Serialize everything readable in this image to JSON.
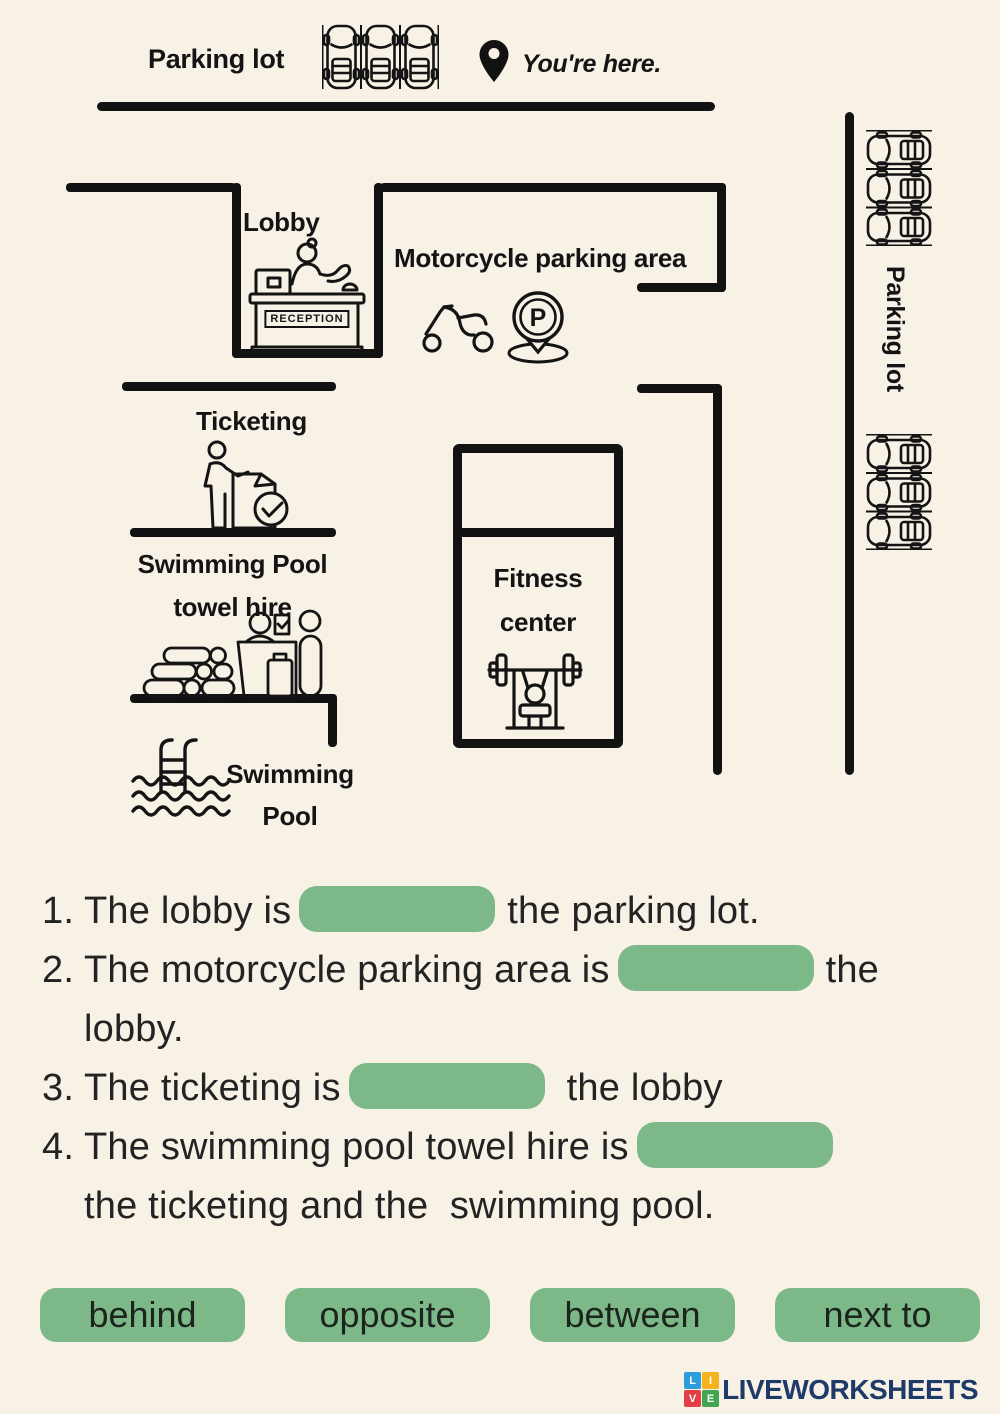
{
  "map": {
    "parking_top_label": "Parking lot",
    "youre_here": "You're here.",
    "lobby": "Lobby",
    "reception": "RECEPTION",
    "motorcycle": "Motorcycle parking area",
    "p_letter": "P",
    "ticketing": "Ticketing",
    "towel_hire": {
      "line1": "Swimming Pool",
      "line2": "towel hire"
    },
    "fitness": {
      "line1": "Fitness",
      "line2": "center"
    },
    "pool": {
      "line1": "Swimming",
      "line2": "Pool"
    },
    "parking_right_label": "Parking lot"
  },
  "questions": [
    {
      "num": "1.",
      "pre": "The lobby is",
      "post": "the parking lot.",
      "line2": ""
    },
    {
      "num": "2.",
      "pre": "The motorcycle parking area is",
      "post": "the",
      "line2": "lobby."
    },
    {
      "num": "3.",
      "pre": "The ticketing is",
      "post": "the lobby",
      "line2": ""
    },
    {
      "num": "4.",
      "pre": "The swimming pool towel hire is",
      "post": "",
      "line2": "the ticketing and the  swimming pool."
    }
  ],
  "word_bank": [
    "behind",
    "opposite",
    "between",
    "next to"
  ],
  "footer": {
    "brand": "LIVEWORKSHEETS",
    "tiles": [
      {
        "letter": "L",
        "color": "#2d9cdb"
      },
      {
        "letter": "I",
        "color": "#f6b31f"
      },
      {
        "letter": "V",
        "color": "#e23f44"
      },
      {
        "letter": "E",
        "color": "#43a453"
      }
    ]
  },
  "icons": {
    "cars-top-icon": "three parked cars, top view in slots",
    "location-pin-icon": "black map pin",
    "reception-desk-icon": "receptionist behind reception desk",
    "scooter-icon": "motor scooter side view",
    "parking-sign-icon": "P letter inside pin sign",
    "ticketing-icon": "person buying ticket with check mark",
    "towel-hire-icon": "towel stack and hire desk with people",
    "swimming-pool-icon": "pool ladder with water waves",
    "fitness-icon": "bench press with barbell",
    "cars-right-icon": "column of parked cars in slots",
    "brand-tiles-icon": "LIVE colored letter tiles"
  },
  "colors": {
    "background": "#f7f1e6",
    "ink": "#121212",
    "blank_green": "#7db888",
    "brand_navy": "#1e3a68"
  }
}
